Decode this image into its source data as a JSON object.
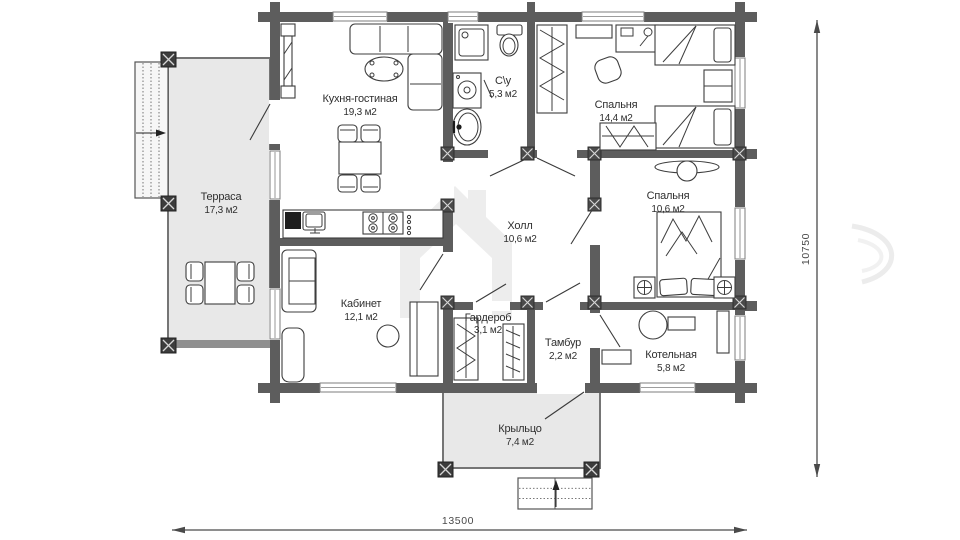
{
  "rooms": {
    "terrace": {
      "name": "Терраса",
      "area": "17,3 м2"
    },
    "kitchen": {
      "name": "Кухня-гостиная",
      "area": "19,3 м2"
    },
    "bathroom": {
      "name": "С\\у",
      "area": "5,3 м2"
    },
    "bedroom1": {
      "name": "Спальня",
      "area": "14,4 м2"
    },
    "bedroom2": {
      "name": "Спальня",
      "area": "10,6 м2"
    },
    "hall": {
      "name": "Холл",
      "area": "10,6 м2"
    },
    "office": {
      "name": "Кабинет",
      "area": "12,1 м2"
    },
    "wardrobe": {
      "name": "Гардероб",
      "area": "3,1 м2"
    },
    "vestibule": {
      "name": "Тамбур",
      "area": "2,2 м2"
    },
    "boiler": {
      "name": "Котельная",
      "area": "5,8 м2"
    },
    "porch": {
      "name": "Крыльцо",
      "area": "7,4 м2"
    }
  },
  "dimensions": {
    "width": "13500",
    "height": "10750"
  },
  "colors": {
    "wall": "#5d5d5d",
    "deck": "#e8e8e8",
    "text": "#2f2f2f",
    "dim_line": "#4a4a4a",
    "watermark": "#ededed"
  }
}
